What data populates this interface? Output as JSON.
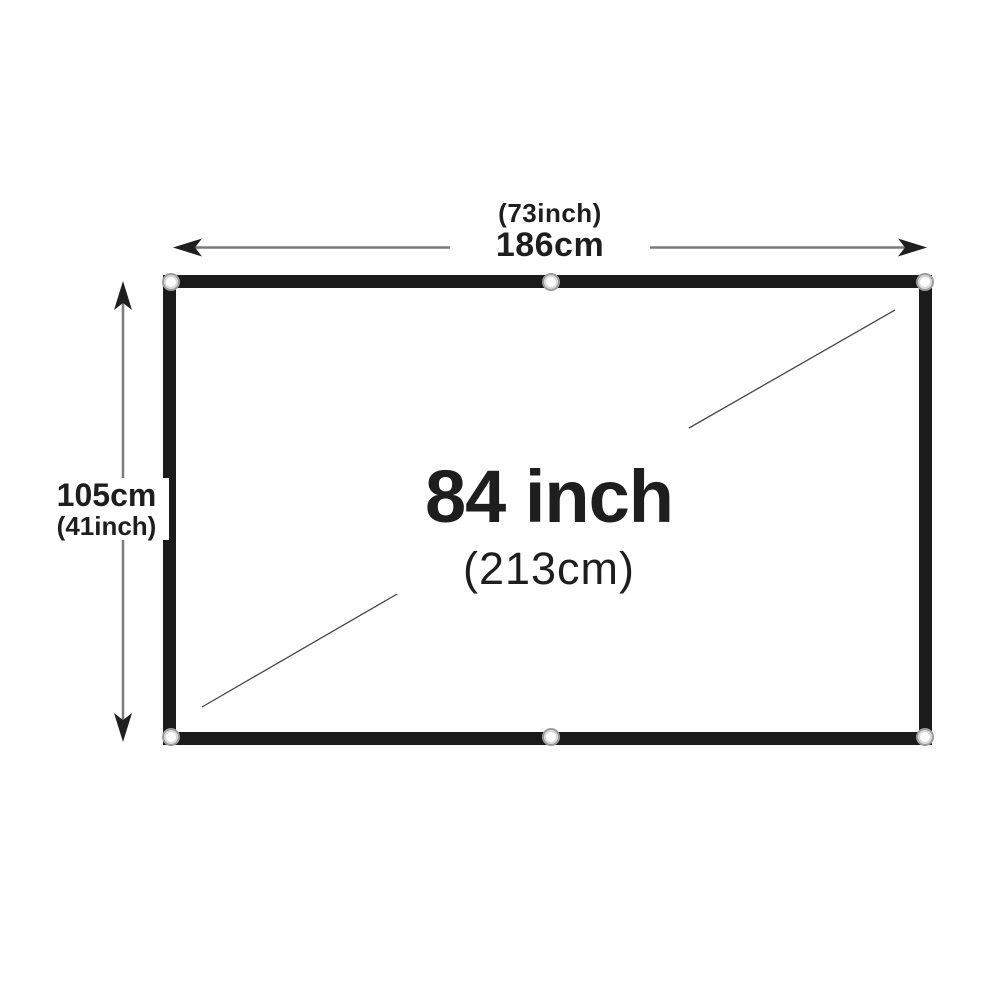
{
  "diagram": {
    "width": {
      "inch_label": "(73inch)",
      "cm_label": "186cm"
    },
    "height": {
      "cm_label": "105cm",
      "inch_label": "(41inch)"
    },
    "diagonal": {
      "size_label": "84 inch",
      "cm_label": "(213cm)"
    }
  },
  "icons": {
    "grommet": "metal-eyelet-ring"
  },
  "colors": {
    "background": "#ffffff",
    "screen_border": "#1b1b1b",
    "screen_surface": "#ffffff",
    "label_text": "#1e1e1e",
    "arrow_shaft": "#7b7b7b",
    "arrow_head": "#1f1f1f",
    "diagonal_line": "#474747",
    "grommet_ring": "#9c9c9c",
    "grommet_inner": "#d9d9d9",
    "grommet_center": "#ffffff"
  }
}
